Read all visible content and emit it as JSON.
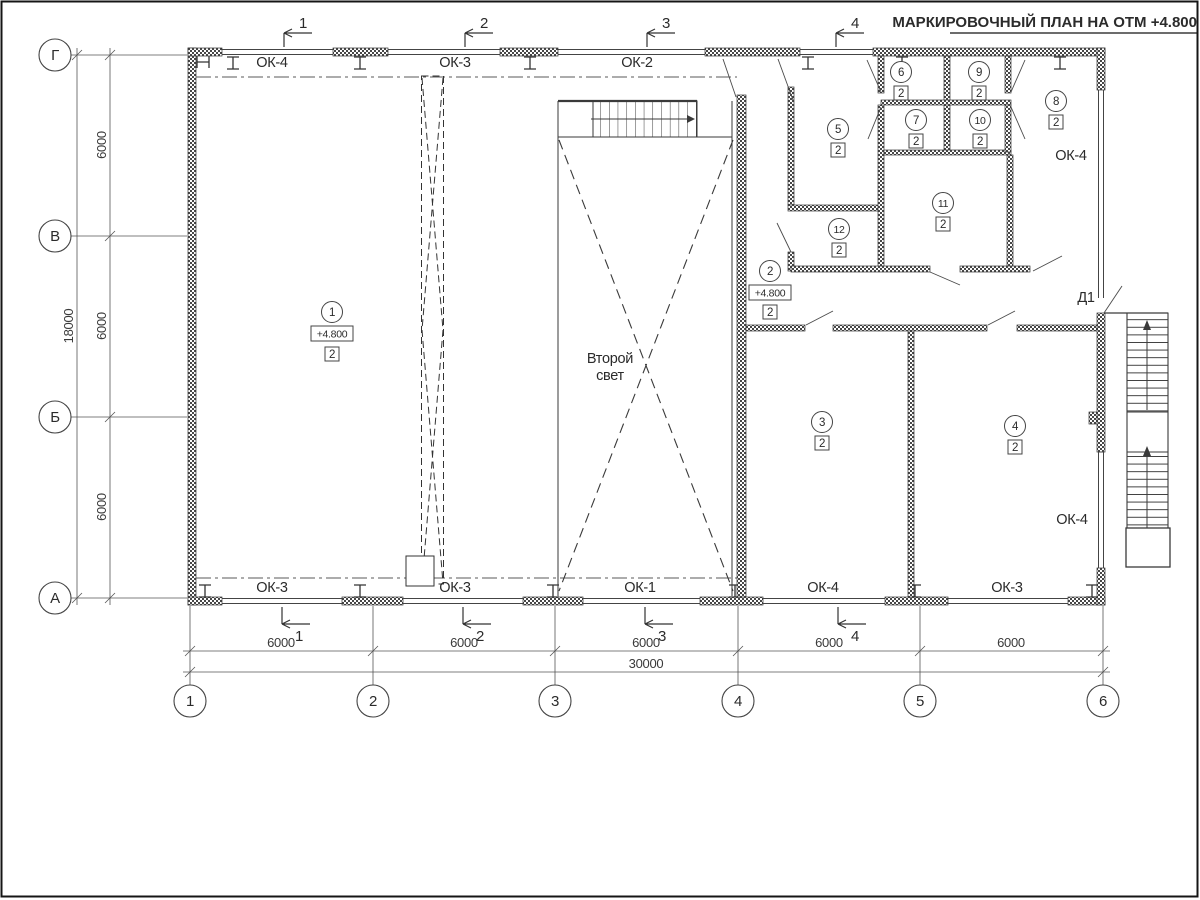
{
  "title": "МАРКИРОВОЧНЫЙ ПЛАН НА ОТМ +4.800",
  "grid": {
    "cols": [
      "1",
      "2",
      "3",
      "4",
      "5",
      "6"
    ],
    "rows": [
      "Г",
      "В",
      "Б",
      "А"
    ]
  },
  "dims": {
    "col_spans": [
      "6000",
      "6000",
      "6000",
      "6000",
      "6000"
    ],
    "col_total": "30000",
    "row_spans": [
      "6000",
      "6000",
      "6000"
    ],
    "row_total": "18000"
  },
  "sections": [
    "1",
    "2",
    "3",
    "4"
  ],
  "windows": {
    "top": [
      "ОК-4",
      "ОК-3",
      "ОК-2"
    ],
    "bottom": [
      "ОК-3",
      "ОК-3",
      "ОК-1",
      "ОК-4",
      "ОК-3"
    ],
    "right_top": "ОК-4",
    "right_bottom": "ОК-4"
  },
  "door_label": "Д1",
  "second_light": [
    "Второй",
    "свет"
  ],
  "rooms": [
    {
      "num": "1",
      "type": "2",
      "elev": "+4.800"
    },
    {
      "num": "2",
      "type": "2",
      "elev": "+4.800"
    },
    {
      "num": "3",
      "type": "2"
    },
    {
      "num": "4",
      "type": "2"
    },
    {
      "num": "5",
      "type": "2"
    },
    {
      "num": "6",
      "type": "2"
    },
    {
      "num": "7",
      "type": "2"
    },
    {
      "num": "8",
      "type": "2"
    },
    {
      "num": "9",
      "type": "2"
    },
    {
      "num": "10",
      "type": "2"
    },
    {
      "num": "11",
      "type": "2"
    },
    {
      "num": "12",
      "type": "2"
    }
  ]
}
